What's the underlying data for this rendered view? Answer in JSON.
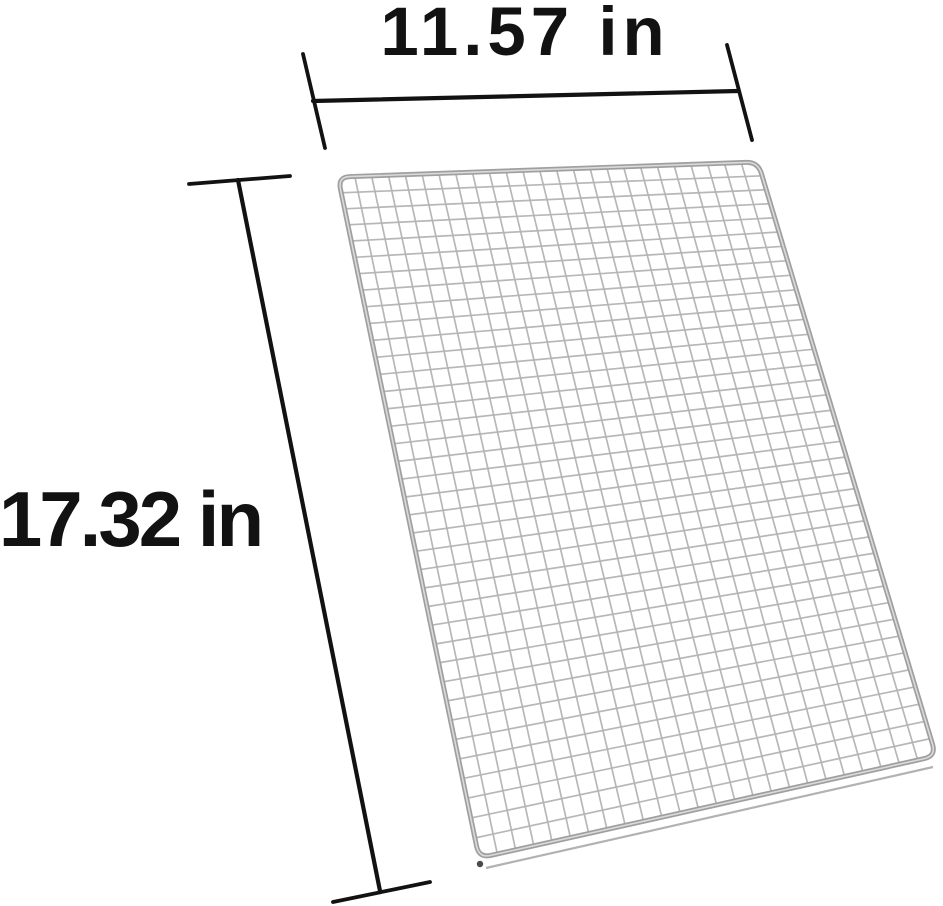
{
  "figure": {
    "title": "Wire mesh grill grate dimension diagram",
    "width_label": "11.57 in",
    "height_label": "17.32 in"
  },
  "colors": {
    "dimension": "#121212",
    "wire": "#b4b4b4",
    "frame_outer": "#9f9f9f",
    "frame_inner": "#dadada",
    "shadow_line": "#aeaeae",
    "corner_dot": "#4a4a4a",
    "background": "#ffffff"
  },
  "mesh": {
    "columns": 25,
    "rows": 38,
    "corners": {
      "top_left": [
        338,
        177
      ],
      "top_right": [
        758,
        162
      ],
      "bottom_right": [
        936,
        756
      ],
      "bottom_left": [
        479,
        858
      ]
    },
    "foreshorten": 0.12,
    "corner_radius": 12,
    "wire_width": 1.7,
    "frame_width": 5
  }
}
